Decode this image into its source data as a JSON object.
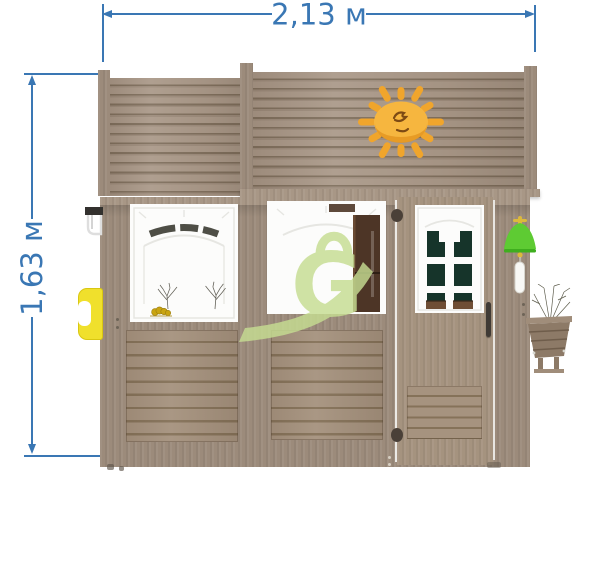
{
  "theme": {
    "dimension-blue": "#3a77b4",
    "wood-light": "#ab9a8a",
    "wood-dark": "#80705e",
    "wood-frame": "#9c8b7b",
    "wood-frame-light": "#a89786",
    "wood-board": "#a6937f",
    "wood-board-dark": "#857259",
    "door-wood": "#a5937f",
    "window-white": "#fcfcfb",
    "pane-green": "#16342a",
    "sill-brown": "#6f4e35",
    "interior-brown": "#4d3526",
    "sun-yellow": "#f6b63f",
    "sun-ray": "#f0a52c",
    "sun-shade": "#e2921e",
    "bell-green": "#5ecb33",
    "cord-white": "#f8f8f5",
    "handle-yellow": "#f0e02c",
    "watermark-green": "#c6dd92",
    "caterpillar-yellow": "#c9a411"
  },
  "dimensions": {
    "width": {
      "label": "2,13 м"
    },
    "height": {
      "label": "1,63 м"
    }
  },
  "watermark": {
    "letter": "G"
  }
}
